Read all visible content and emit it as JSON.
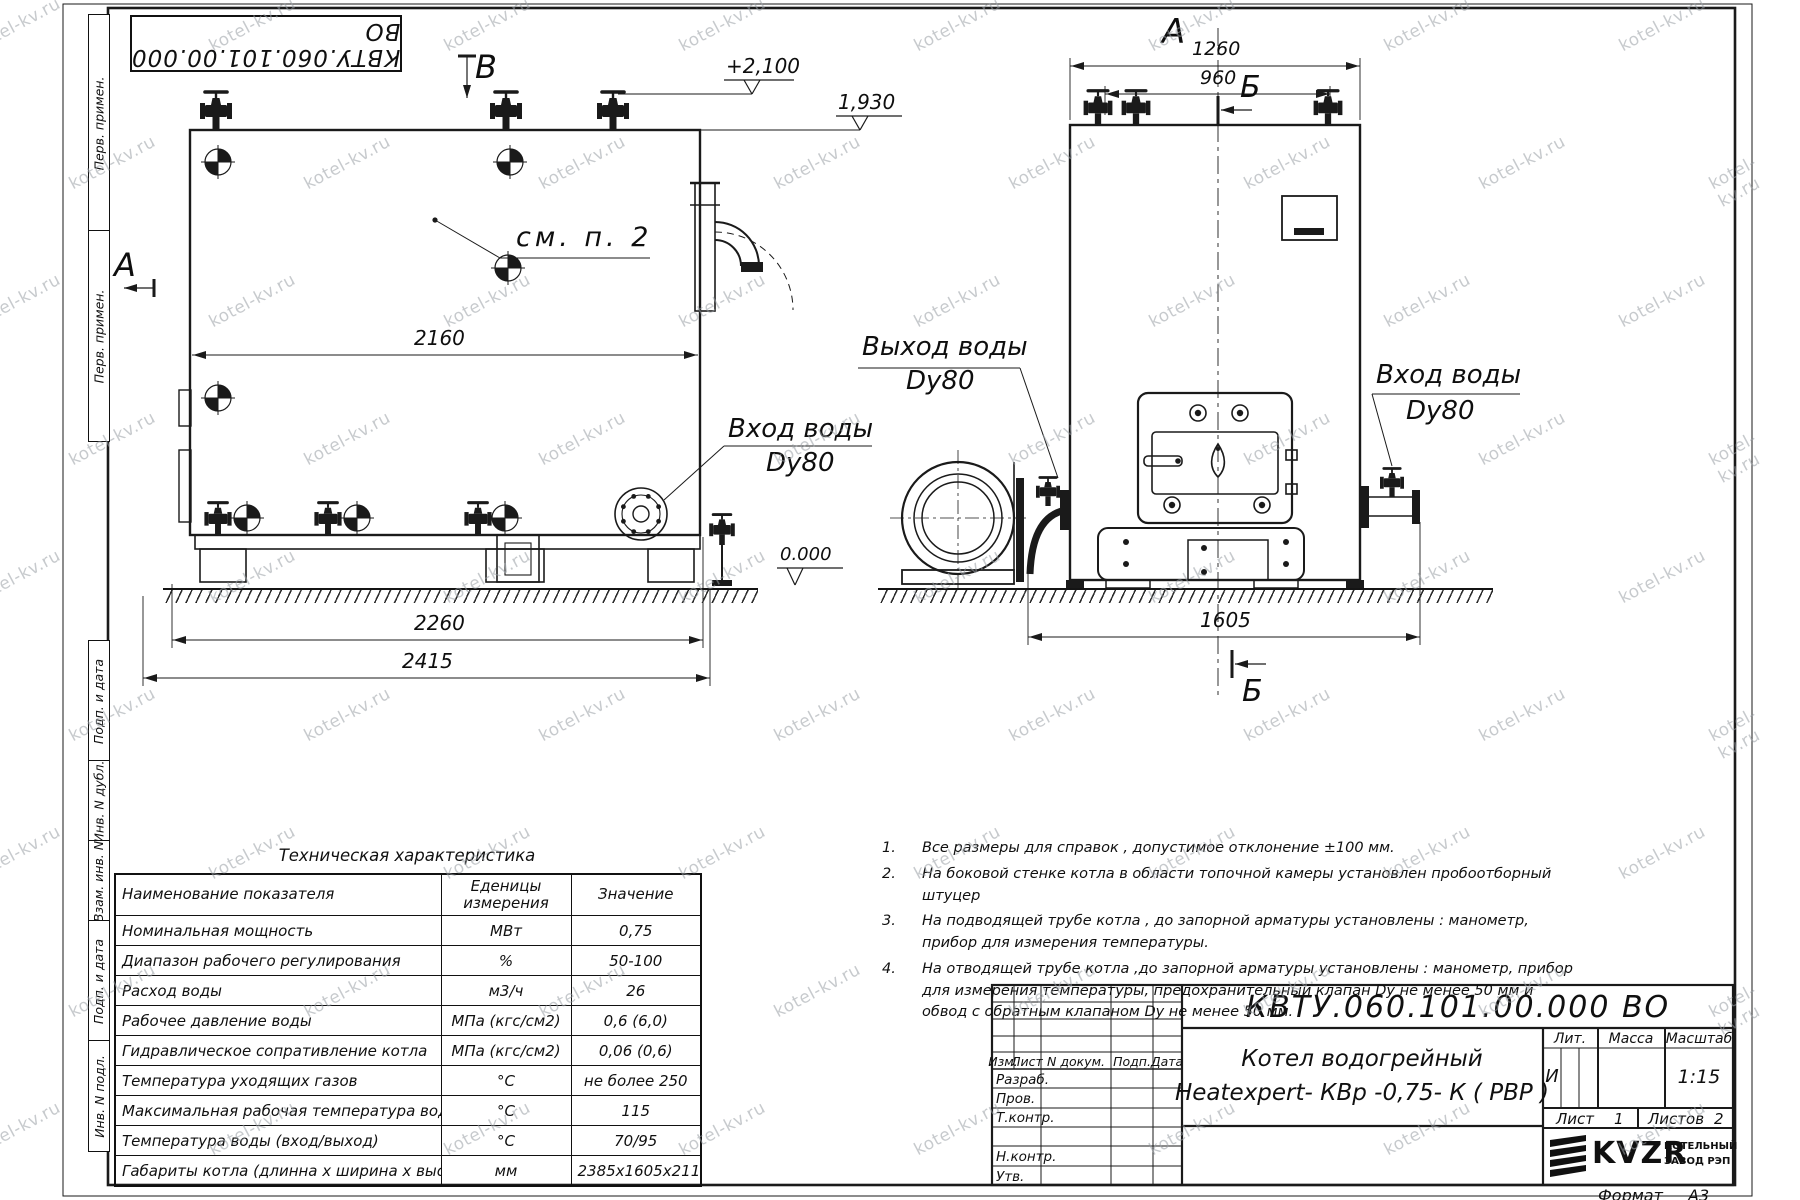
{
  "watermark": "kotel-kv.ru",
  "stamp_top": "КВТУ.060.101.00.000  ВО",
  "margin_labels": {
    "top": [
      "Перв. примен.",
      "Перв. примен."
    ],
    "bottom": [
      "Подп. и дата",
      "Инв. N дубл.",
      "Взам. инв. N",
      "Подп. и дата",
      "Инв. N подл."
    ]
  },
  "views": {
    "left": {
      "section_b": "В",
      "section_a": "А",
      "see_note": "см. п. 2",
      "dim_2160": "2160",
      "dim_2260": "2260",
      "dim_2415": "2415",
      "elev_high": "+2,100",
      "elev_mid": "1,930",
      "elev_zero": "0.000",
      "inlet_line1": "Вход воды",
      "inlet_line2": "Dy80"
    },
    "front": {
      "view_label": "А",
      "dim_1260": "1260",
      "dim_960": "960",
      "dim_1605": "1605",
      "section_top": "Б",
      "section_bottom": "Б",
      "outlet_line1": "Выход воды",
      "outlet_line2": "Dy80",
      "inlet_line1": "Вход воды",
      "inlet_line2": "Dy80"
    }
  },
  "notes": [
    {
      "num": "1.",
      "text": "Все размеры для справок , допустимое отклонение  ±100 мм."
    },
    {
      "num": "2.",
      "text": "На боковой стенке котла в области топочной камеры установлен пробоотборный штуцер"
    },
    {
      "num": "3.",
      "text": "На  подводящей трубе котла , до запорной арматуры установлены : манометр, прибор для измерения температуры."
    },
    {
      "num": "4.",
      "text": "На отводящей трубе котла ,до запорной арматуры установлены : манометр, прибор для измерения температуры, предохранительный клапан  Dу не менее  50 мм и обвод с обратным клапаном  Dу не менее  50 мм."
    }
  ],
  "tech_table": {
    "title": "Техническая характеристика",
    "col_name": "Наименование показателя",
    "col_units": "Еденицы измерения",
    "col_value": "Значение",
    "rows": [
      {
        "name": "Номинальная мощность",
        "units": "МВт",
        "value": "0,75"
      },
      {
        "name": "Диапазон рабочего регулирования",
        "units": "%",
        "value": "50-100"
      },
      {
        "name": "Расход воды",
        "units": "м3/ч",
        "value": "26"
      },
      {
        "name": "Рабочее давление воды",
        "units": "МПа (кгс/см2)",
        "value": "0,6 (6,0)"
      },
      {
        "name": "Гидравлическое сопративление котла",
        "units": "МПа (кгс/см2)",
        "value": "0,06 (0,6)"
      },
      {
        "name": "Температура уходящих газов",
        "units": "°С",
        "value": "не более 250"
      },
      {
        "name": "Максимальная рабочая температура воды",
        "units": "°С",
        "value": "115"
      },
      {
        "name": "Температура воды (вход/выход)",
        "units": "°С",
        "value": "70/95"
      },
      {
        "name": "Габариты котла (длинна х ширина х высота)",
        "units": "мм",
        "value": "2385х1605х2117"
      }
    ]
  },
  "title_block": {
    "doc_number": "КВТУ.060.101.00.000  ВО",
    "product_line1": "Котел водогрейный",
    "product_line2": "Heatexpert- КВр -0,75- К ( РВР )",
    "grid_headers": [
      "Изм.",
      "Лист",
      "N докум.",
      "Подп.",
      "Дата"
    ],
    "staff_rows": [
      "Разраб.",
      "Пров.",
      "Т.контр.",
      "",
      "Н.контр.",
      "Утв."
    ],
    "lit_label": "Лит.",
    "lit_value": "И",
    "mass_label": "Масса",
    "scale_label": "Масштаб",
    "scale_value": "1:15",
    "sheet_label": "Лист",
    "sheet_value": "1",
    "sheets_label": "Листов",
    "sheets_value": "2",
    "logo_text": "KVZR",
    "logo_sub1": "КОТЕЛЬНЫЙ",
    "logo_sub2": "ЗАВОД РЭП",
    "format_label": "Формат",
    "format_value": "А3"
  }
}
